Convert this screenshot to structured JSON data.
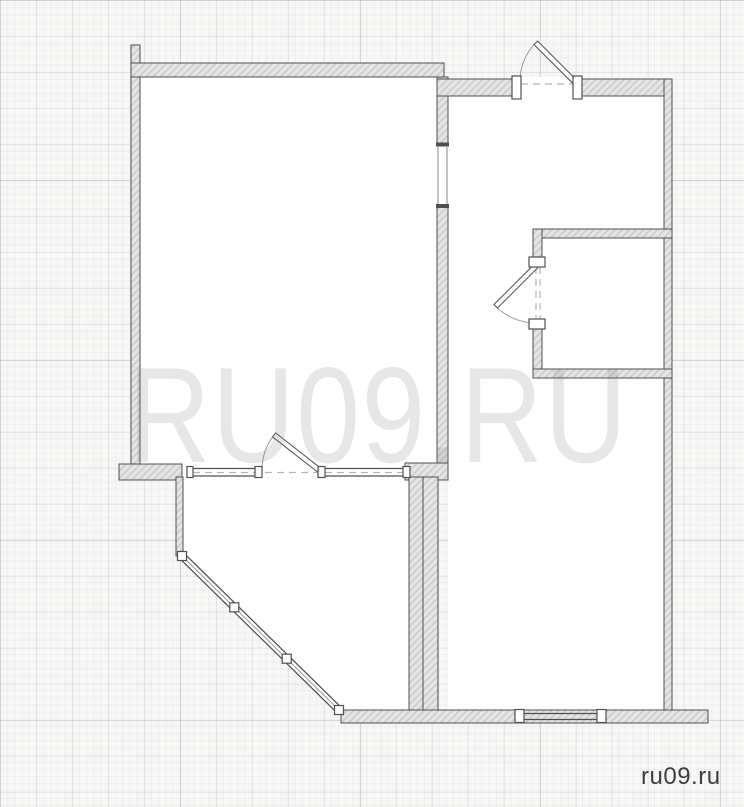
{
  "watermark": {
    "text": "RU09.RU"
  },
  "footer": {
    "site_label": "ru09.ru"
  },
  "colors": {
    "background": "#f7f7f6",
    "room_fill": "#ffffff",
    "wall_fill": "#e5e5e5",
    "wall_hatch": "#c8c8c8",
    "wall_border": "#4f4f4f",
    "door_arc": "#9a9a9a",
    "opening_dash": "#b5b5b5",
    "watermark_color": "rgba(120,120,120,0.18)",
    "site_label_color": "#3e3e3e"
  },
  "plan": {
    "type": "apartment-floor-plan",
    "doors": [
      "entrance-door",
      "small-room-door",
      "balcony-door"
    ],
    "windows": [
      "balcony-partition-window-left",
      "balcony-partition-window-right",
      "bottom-window",
      "balcony-diagonal-glazing"
    ],
    "openings": [
      "middle-wall-opening"
    ]
  }
}
